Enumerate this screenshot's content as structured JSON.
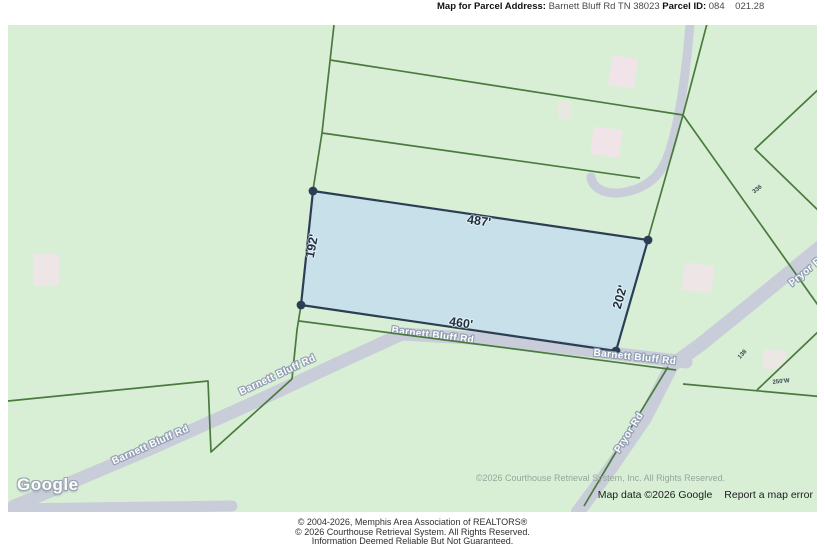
{
  "header": {
    "address_label": "Map for Parcel Address:",
    "address_value": " Barnett Bluff Rd TN 38023 ",
    "parcel_label": "Parcel ID:",
    "parcel_value": " 084    021.28"
  },
  "map": {
    "watermark": "Google",
    "roads": {
      "barnett_bluff": "Barnett Bluff Rd",
      "pryor": "Pryor Rd"
    },
    "parcel_dims": {
      "top": "487'",
      "bottom": "460'",
      "left": "192'",
      "right": "202'"
    },
    "neighbor_labels": {
      "a": "336",
      "b": "138",
      "c": "250'W"
    },
    "copyright_overlay": "©2026 Courthouse Retrieval System, Inc. All Rights Reserved.",
    "map_data_attribution": "Map data ©2026 Google",
    "report_error": "Report a map error"
  },
  "footer": {
    "line1": "© 2004-2026, Memphis Area Association of REALTORS®",
    "line2": "© 2026 Courthouse Retrieval System. All Rights Reserved.",
    "line3": "Information Deemed Reliable But Not Guaranteed."
  },
  "colors": {
    "map_background": "#d8efd6",
    "road_fill": "#c8cdd9",
    "parcel_line": "#4a7a3e",
    "parcel_fill": "#c5ddec",
    "parcel_border": "#2b3e54",
    "building_fill": "#f1e3e9"
  }
}
